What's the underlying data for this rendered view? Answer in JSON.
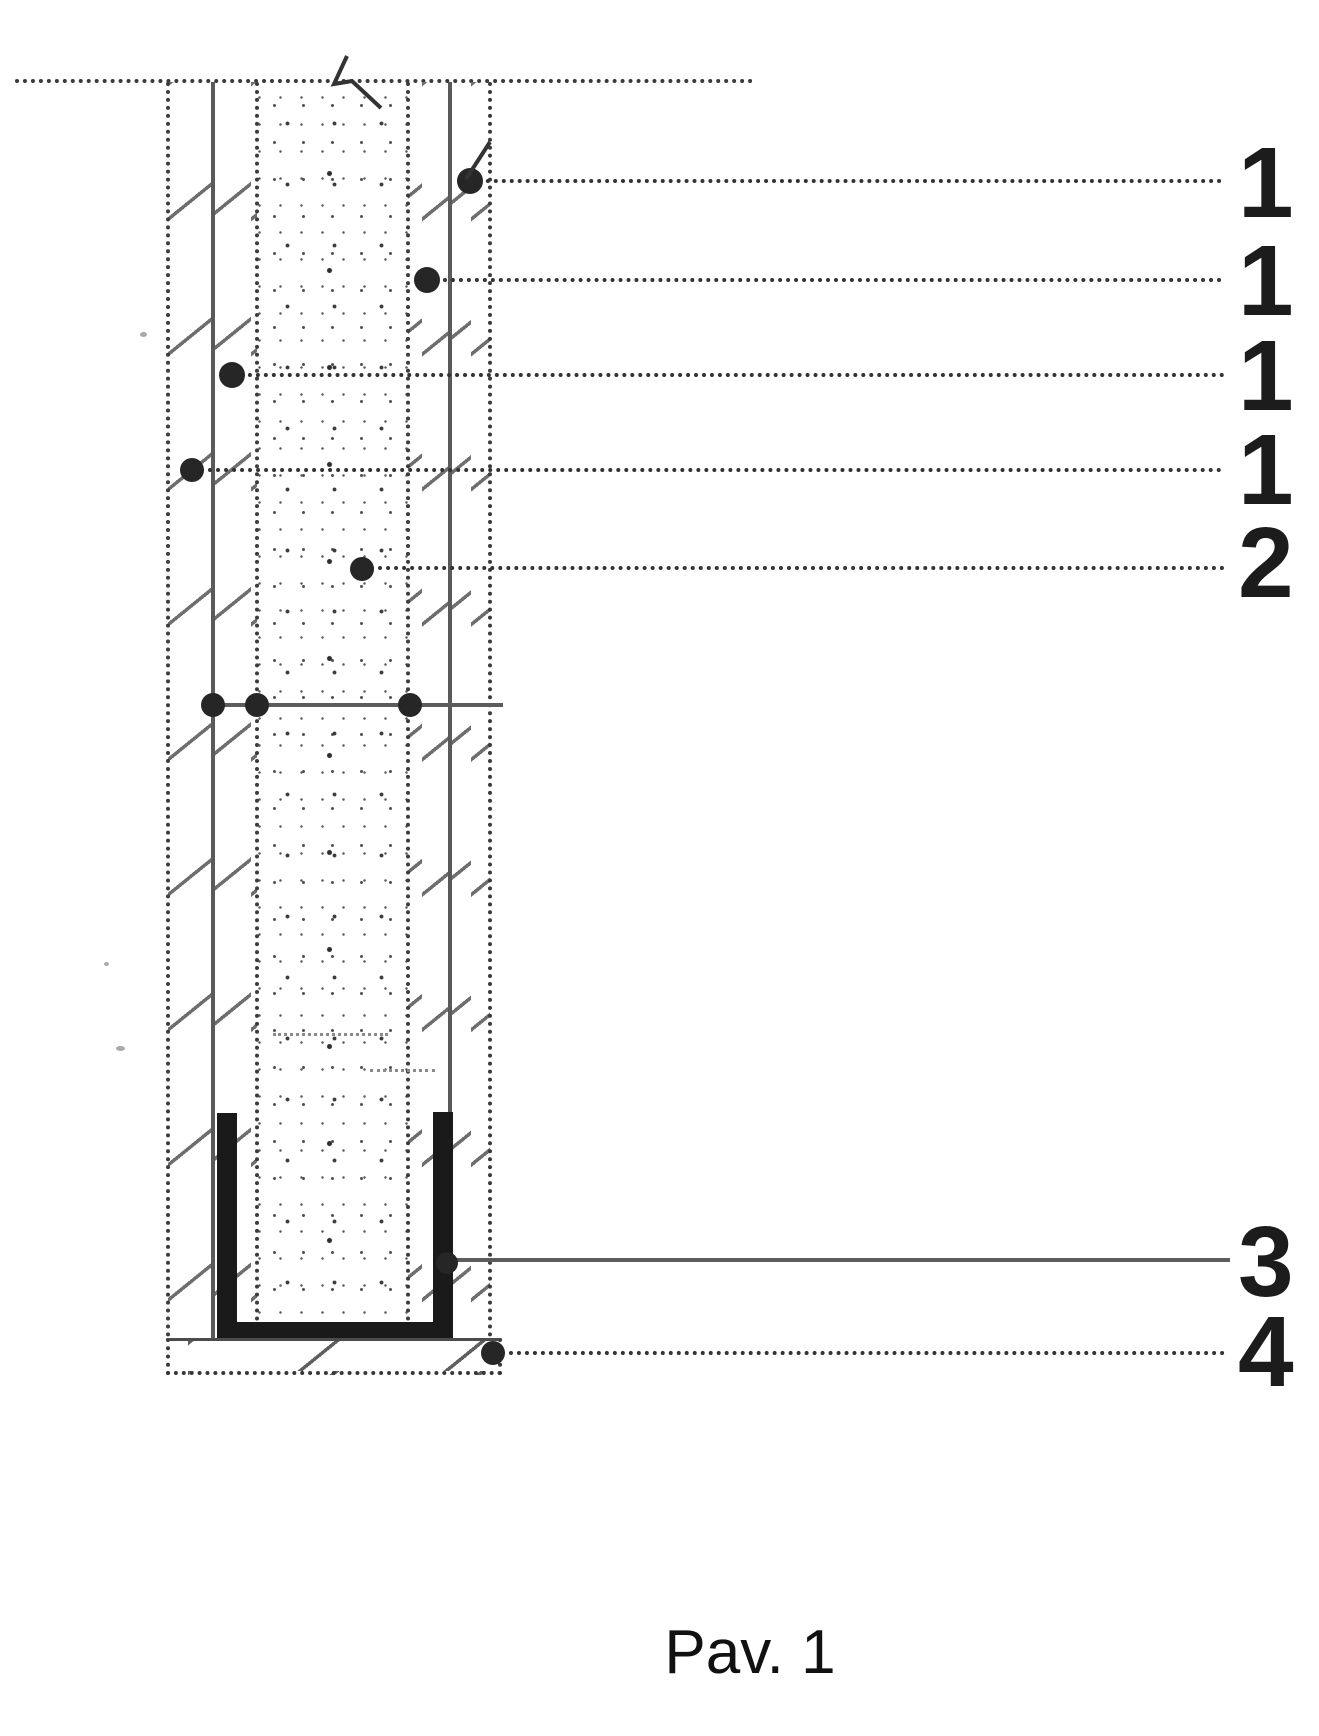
{
  "figure": {
    "caption": "Pav. 1",
    "ref_labels": [
      "1",
      "1",
      "1",
      "1",
      "2",
      "3",
      "4"
    ],
    "colors": {
      "ink": "#1c1c1c",
      "line_gray": "#5c5c5c",
      "paper": "#ffffff"
    }
  }
}
